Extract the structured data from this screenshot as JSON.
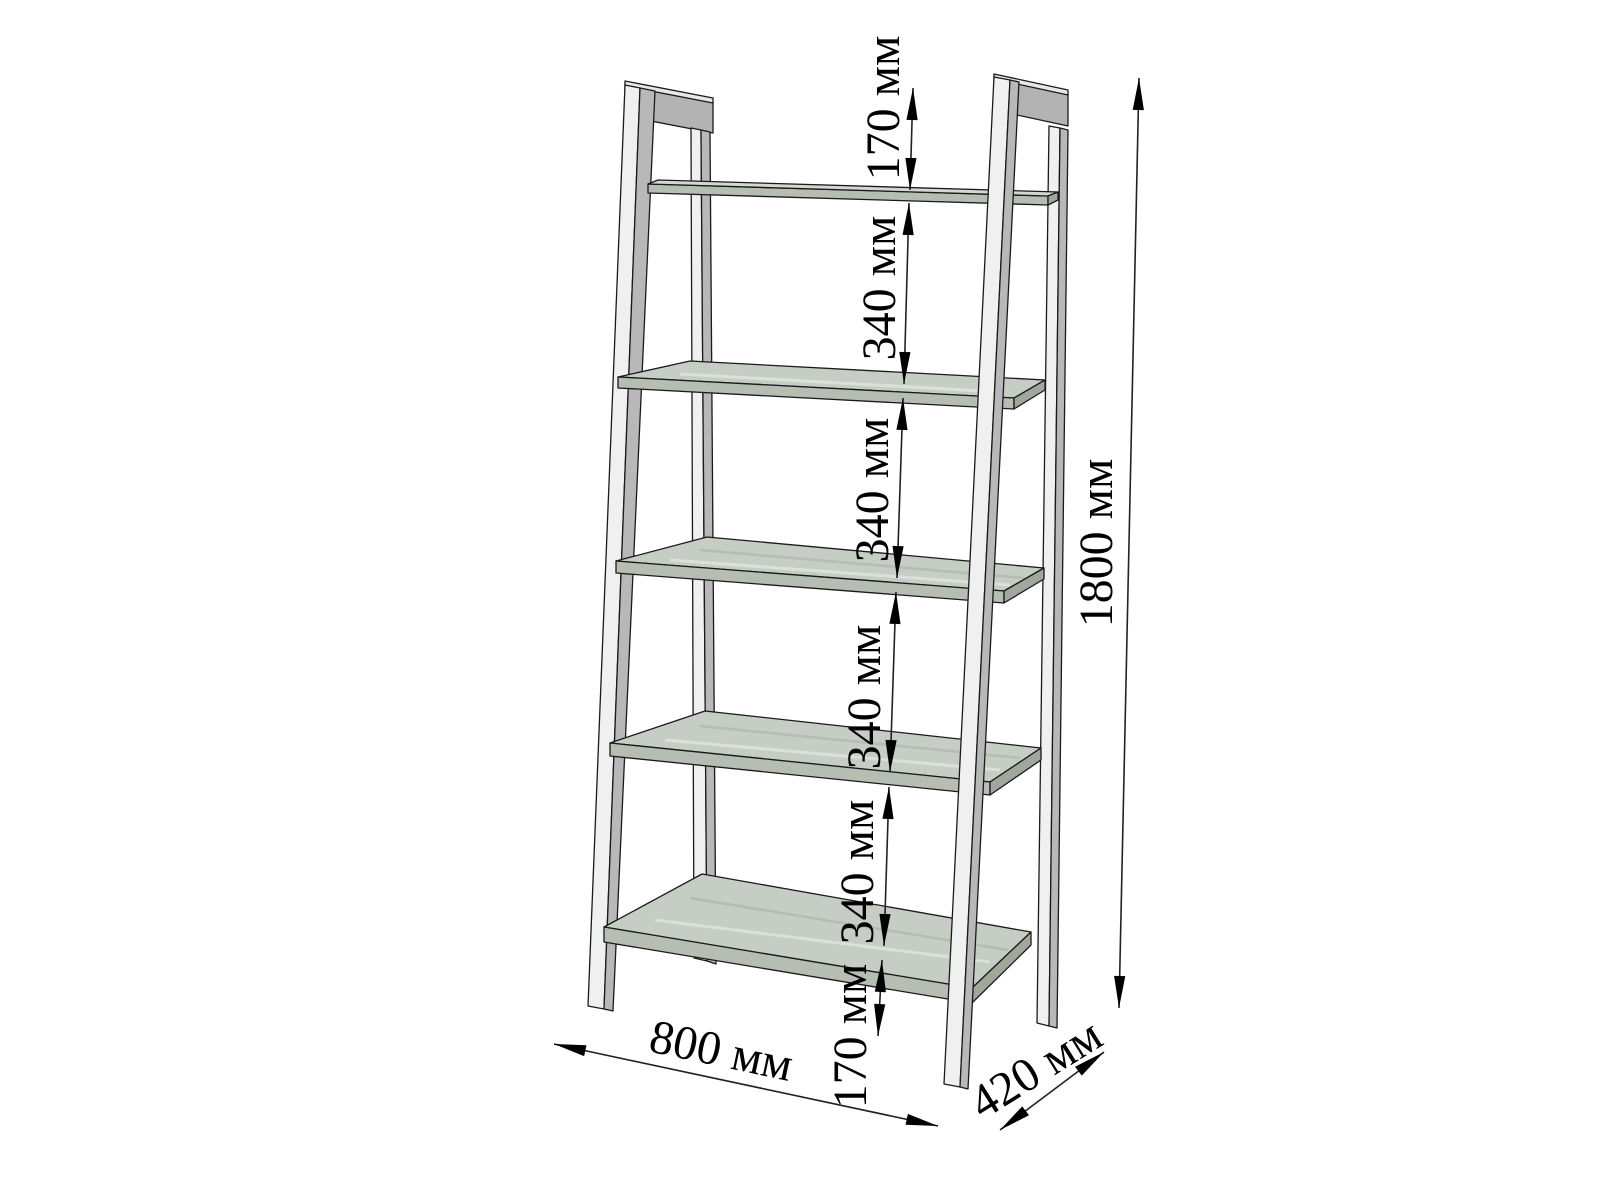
{
  "diagram": {
    "type": "furniture dimension drawing",
    "object": "ladder shelf rack",
    "shelf_count": 5,
    "unit": "мм",
    "labels": {
      "chain": [
        "170 мм",
        "340 мм",
        "340 мм",
        "340 мм",
        "340 мм",
        "170 мм"
      ],
      "height": "1800 мм",
      "width": "800 мм",
      "depth": "420 мм"
    },
    "values": {
      "height_mm": 1800,
      "width_mm": 800,
      "depth_mm": 420,
      "top_gap_mm": 170,
      "shelf_spacing_mm": 340,
      "bottom_gap_mm": 170
    },
    "colors": {
      "background": "#ffffff",
      "leg_front": "#f0f0f0",
      "leg_side": "#b8b8b8",
      "frame_bar": "#b3b3b3",
      "shelf_top": "#c6cdc4",
      "shelf_front": "#b6beb3",
      "shelf_edge": "#a0a89d",
      "outline": "#1a1a1a",
      "dimension_ink": "#000000"
    }
  }
}
